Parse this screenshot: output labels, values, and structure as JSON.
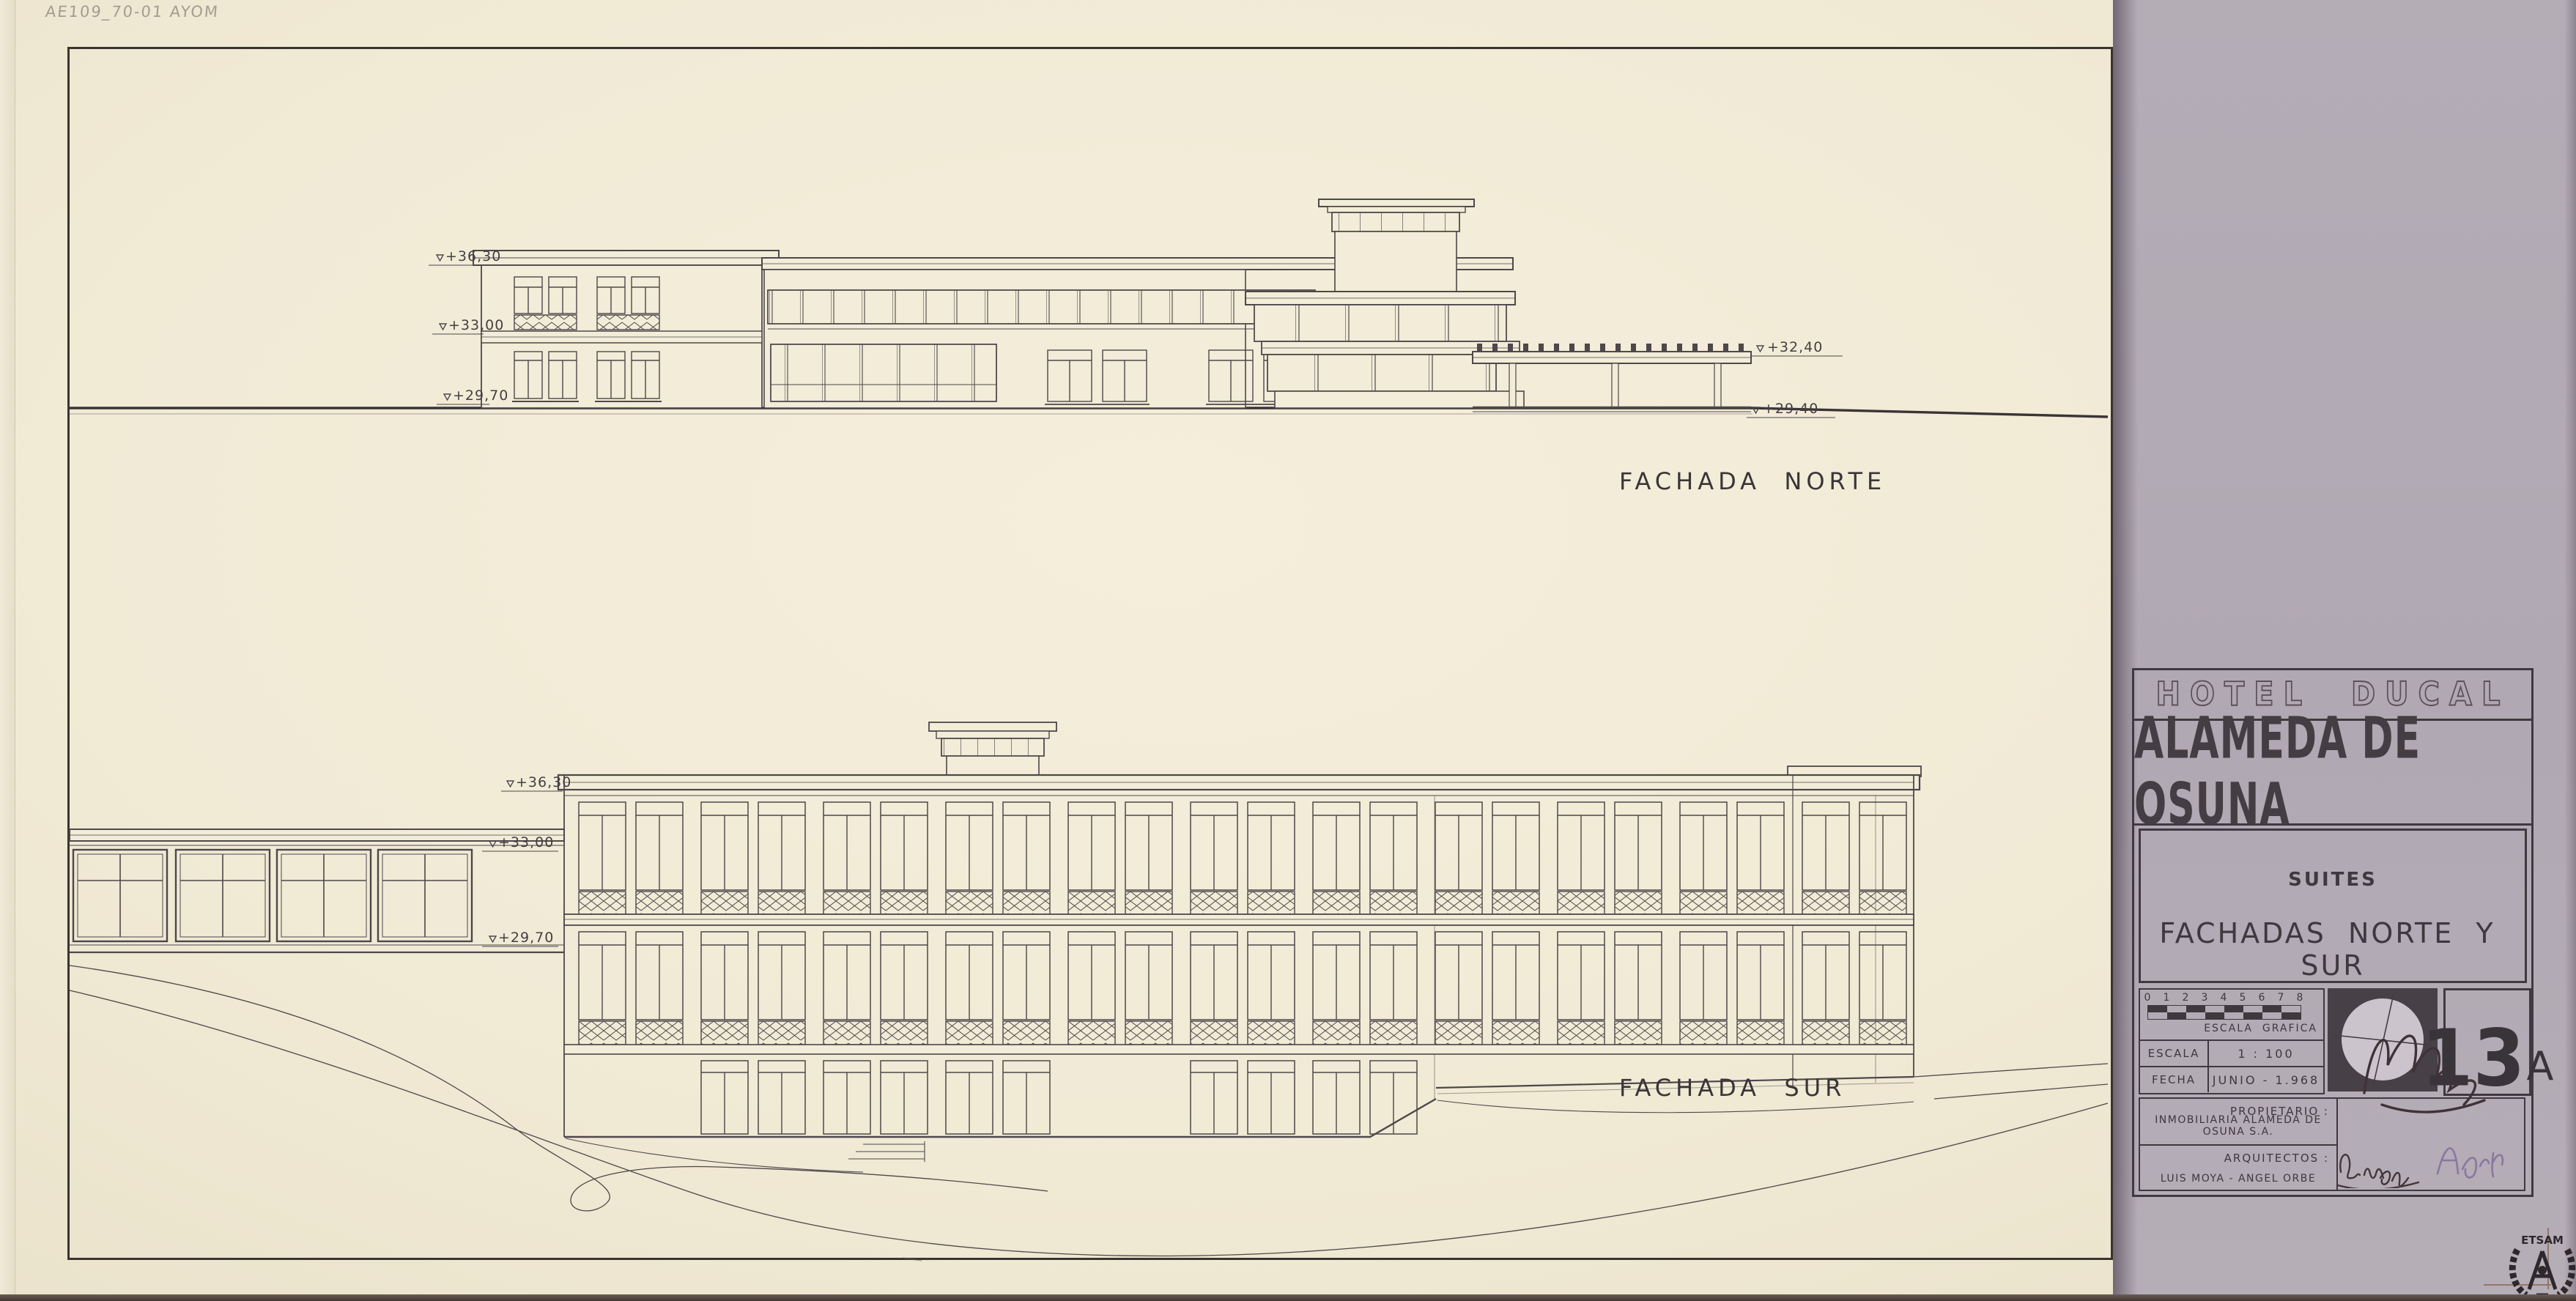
{
  "sheet": {
    "pencil_note": "AE109_70-01 AYOM",
    "north_facade": {
      "label": "FACHADA  NORTE",
      "elev_roof": "+36,30",
      "elev_floor": "+33,00",
      "elev_ground": "+29,70",
      "elev_pergola_roof": "+32,40",
      "elev_pergola_ground": "+29,40"
    },
    "south_facade": {
      "label": "FACHADA  SUR",
      "elev_roof": "+36,30",
      "elev_wing_top": "+33,00",
      "elev_wing_base": "+29,70"
    }
  },
  "title_block": {
    "project": "HOTEL  DUCAL",
    "location": "ALAMEDA DE OSUNA",
    "section": "SUITES",
    "sheet_title": "FACHADAS  NORTE  Y  SUR",
    "scale_bar": {
      "ticks": [
        "0",
        "1",
        "2",
        "3",
        "4",
        "5",
        "6",
        "7",
        "8"
      ],
      "caption": "ESCALA  GRAFICA"
    },
    "fields": [
      {
        "label": "ESCALA",
        "value": "1 : 100"
      },
      {
        "label": "FECHA",
        "value": "JUNIO - 1.968"
      }
    ],
    "drawing_number": {
      "number": "13",
      "suffix": "A"
    },
    "owner": {
      "label": "PROPIETARIO :",
      "value": "INMOBILIARIA ALAMEDA DE OSUNA S.A."
    },
    "architects": {
      "label": "ARQUITECTOS :",
      "value": "LUIS MOYA - ANGEL ORBE"
    },
    "stamp": "ETSAM",
    "colors": {
      "paper": "#f2ecd8",
      "ink": "#4e474b",
      "grey_sheet": "#b3abb4",
      "title_ink": "#3f383e",
      "signature_purple": "#8678a0"
    }
  }
}
